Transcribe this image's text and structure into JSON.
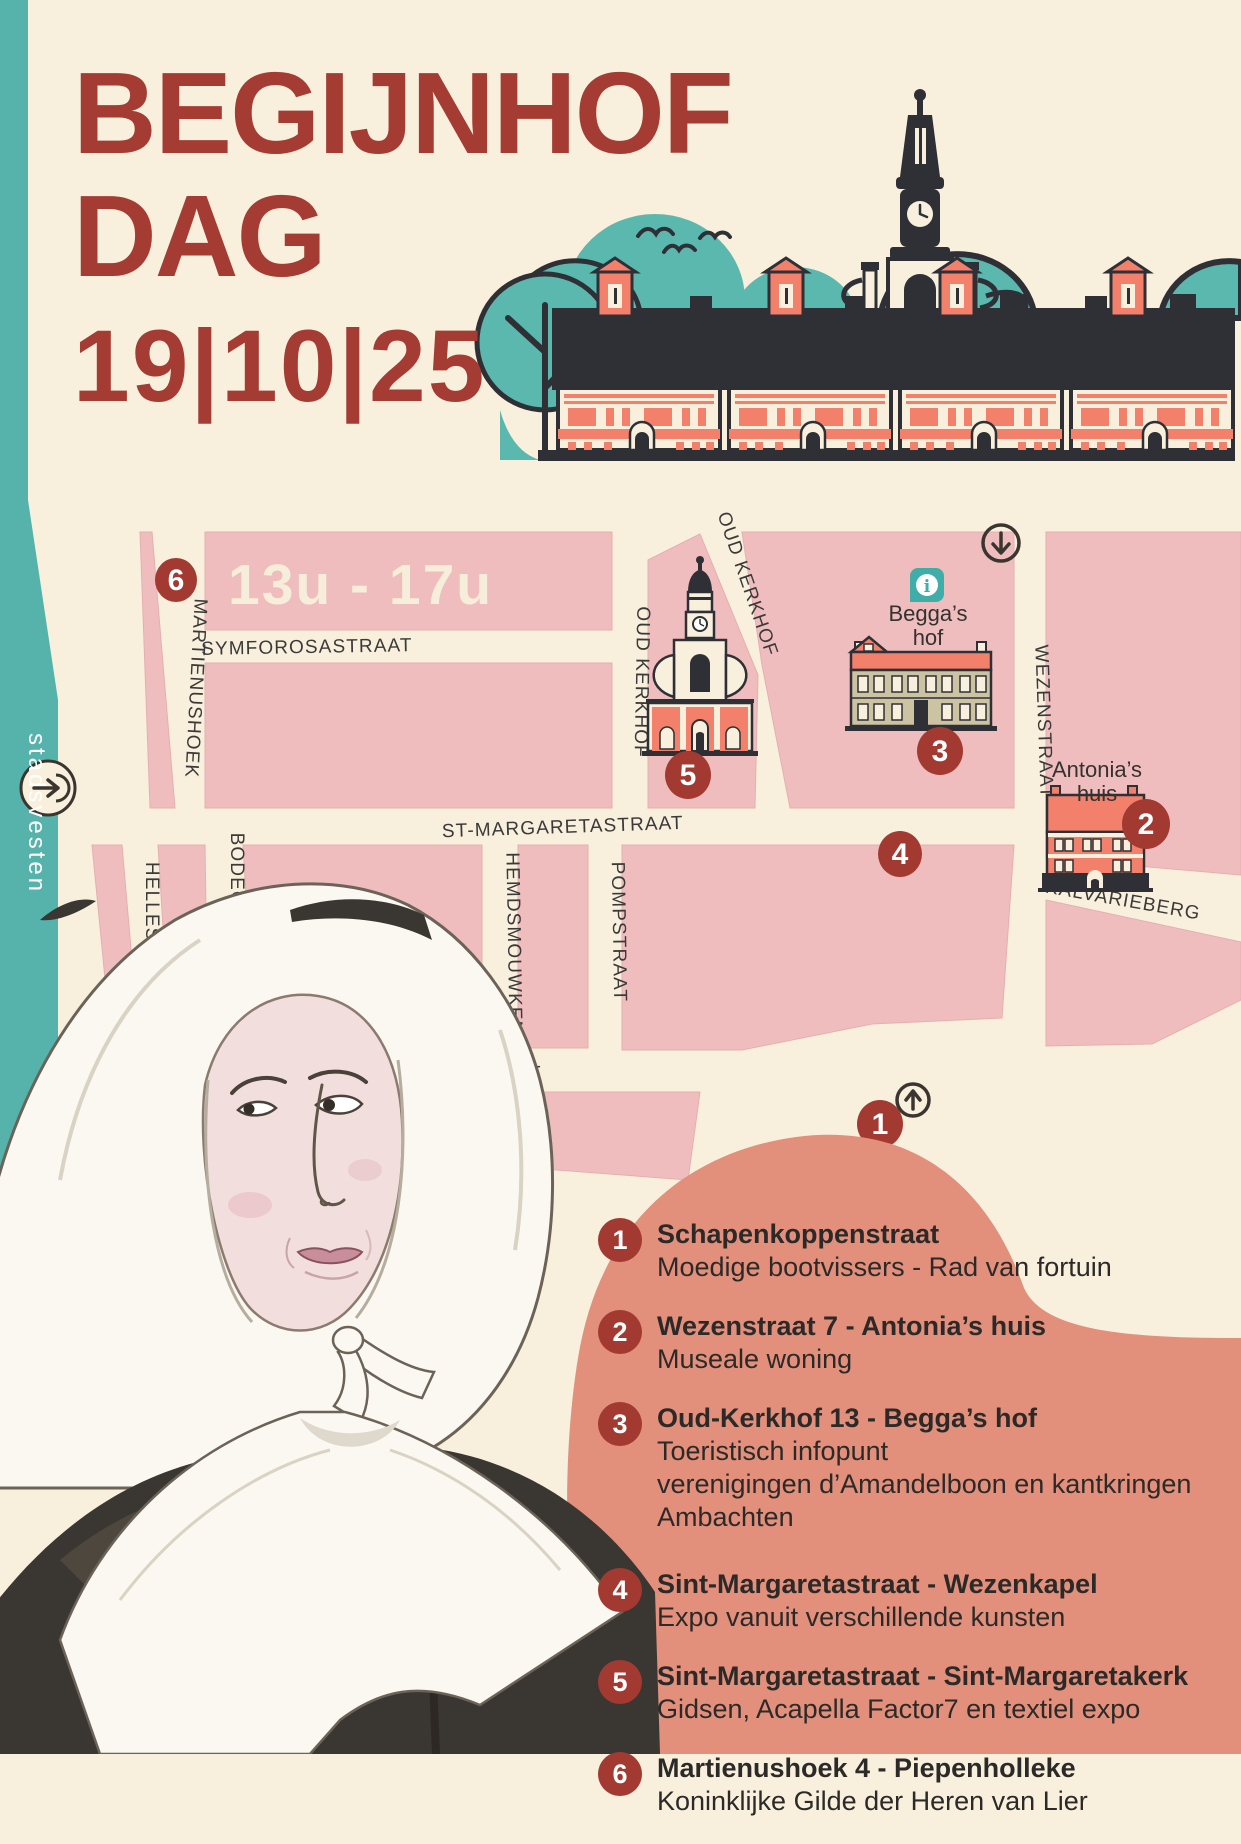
{
  "header": {
    "title_line1": "BEGIJNHOF",
    "title_line2": "DAG",
    "date": "19|10|25"
  },
  "map": {
    "time_range": "13u - 17u",
    "edge_label": "stadsvesten",
    "info_glyph": "i",
    "street_labels": {
      "symforosastraat": "SYMFOROSASTRAAT",
      "martienushoek": "MARTIENUSHOEK",
      "oud_kerkhof_left": "OUD KERKHOF",
      "oud_kerkhof_right": "OUD KERKHOF",
      "st_margaretastraat": "ST-MARGARETASTRAAT",
      "wezenstraat": "WEZENSTRAAT",
      "hellestraat": "HELLEST",
      "bodegemstraat": "BODEGEM",
      "hemdsmouwken": "HEMDSMOUWKEN",
      "pompstraat": "POMPSTRAAT",
      "kalvarieberg": "KALVARIEBERG",
      "htkant": "HTKANT"
    },
    "poi": {
      "beggas_hof": {
        "line1": "Begga’s",
        "line2": "hof"
      },
      "antonias_huis": {
        "line1": "Antonia’s",
        "line2": "huis"
      }
    },
    "markers": [
      {
        "number": "1"
      },
      {
        "number": "2"
      },
      {
        "number": "3"
      },
      {
        "number": "4"
      },
      {
        "number": "5"
      },
      {
        "number": "6"
      }
    ]
  },
  "legend": {
    "items": [
      {
        "num": "1",
        "title": "Schapenkoppenstraat",
        "desc": [
          "Moedige bootvissers - Rad van fortuin"
        ]
      },
      {
        "num": "2",
        "title": "Wezenstraat 7 - Antonia’s huis",
        "desc": [
          "Museale woning"
        ]
      },
      {
        "num": "3",
        "title": "Oud-Kerkhof 13 - Begga’s hof",
        "desc": [
          "Toeristisch infopunt",
          "verenigingen d’Amandelboon en kantkringen",
          "Ambachten"
        ]
      },
      {
        "num": "4",
        "title": "Sint-Margaretastraat - Wezenkapel",
        "desc": [
          "Expo vanuit verschillende kunsten"
        ]
      },
      {
        "num": "5",
        "title": "Sint-Margaretastraat - Sint-Margaretakerk",
        "desc": [
          "Gidsen, Acapella Factor7 en textiel expo"
        ]
      },
      {
        "num": "6",
        "title": "Martienushoek 4 - Piepenholleke",
        "desc": [
          "Koninklijke Gilde der Heren van Lier"
        ]
      }
    ]
  },
  "colors": {
    "brand_red": "#A53C33",
    "marker_red": "#A23A31",
    "teal": "#55B3AB",
    "map_pink": "#F0BDBF",
    "salmon_circle": "#E28F7B",
    "coral": "#F2806B",
    "cream": "#F8F0DC",
    "outline_dark": "#2E3036",
    "tan_facade": "#CCC3A3"
  }
}
